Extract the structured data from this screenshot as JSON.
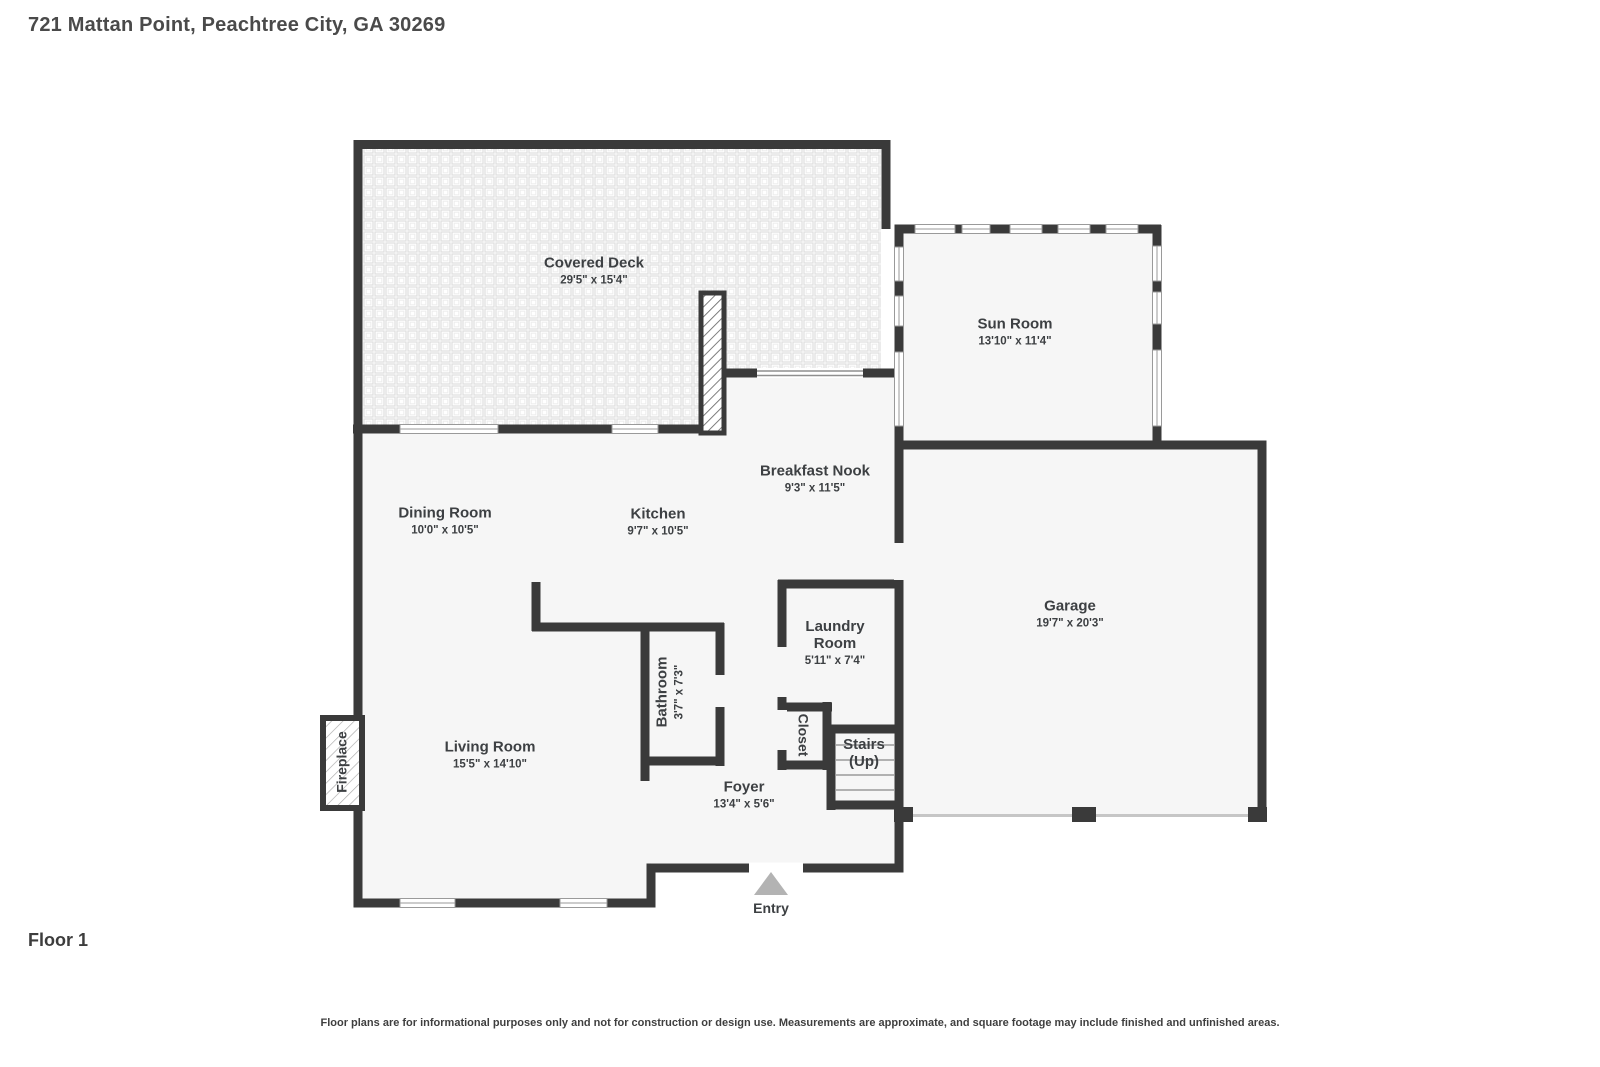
{
  "header": {
    "title": "721 Mattan Point, Peachtree City, GA 30269"
  },
  "floor": {
    "label": "Floor 1"
  },
  "disclaimer": "Floor plans are for informational purposes only and not for construction or design use. Measurements are approximate, and square footage may include finished and unfinished areas.",
  "watermark": {
    "line1": "All 3 Realty",
    "line2": "via RentEngine"
  },
  "rooms": {
    "covered_deck": {
      "name": "Covered Deck",
      "dims": "29'5\" x 15'4\""
    },
    "sun_room": {
      "name": "Sun Room",
      "dims": "13'10\" x 11'4\""
    },
    "breakfast_nook": {
      "name": "Breakfast Nook",
      "dims": "9'3\" x 11'5\""
    },
    "dining_room": {
      "name": "Dining Room",
      "dims": "10'0\" x 10'5\""
    },
    "kitchen": {
      "name": "Kitchen",
      "dims": "9'7\" x 10'5\""
    },
    "garage": {
      "name": "Garage",
      "dims": "19'7\" x 20'3\""
    },
    "laundry_room": {
      "name": "Laundry Room",
      "dims": "5'11\" x 7'4\""
    },
    "bathroom": {
      "name": "Bathroom",
      "dims": "3'7\" x 7'3\""
    },
    "living_room": {
      "name": "Living Room",
      "dims": "15'5\" x 14'10\""
    },
    "foyer": {
      "name": "Foyer",
      "dims": "13'4\" x 5'6\""
    },
    "closet": {
      "name": "Closet"
    },
    "stairs": {
      "name": "Stairs",
      "sub": "(Up)"
    },
    "fireplace": {
      "name": "Fireplace"
    },
    "entry": {
      "name": "Entry"
    }
  },
  "colors": {
    "wall": "#3a3a3a",
    "room_fill": "#f6f6f6",
    "text": "#3d4043",
    "entry_arrow": "#b3b3b3",
    "window_frame": "#9a9a9a"
  }
}
